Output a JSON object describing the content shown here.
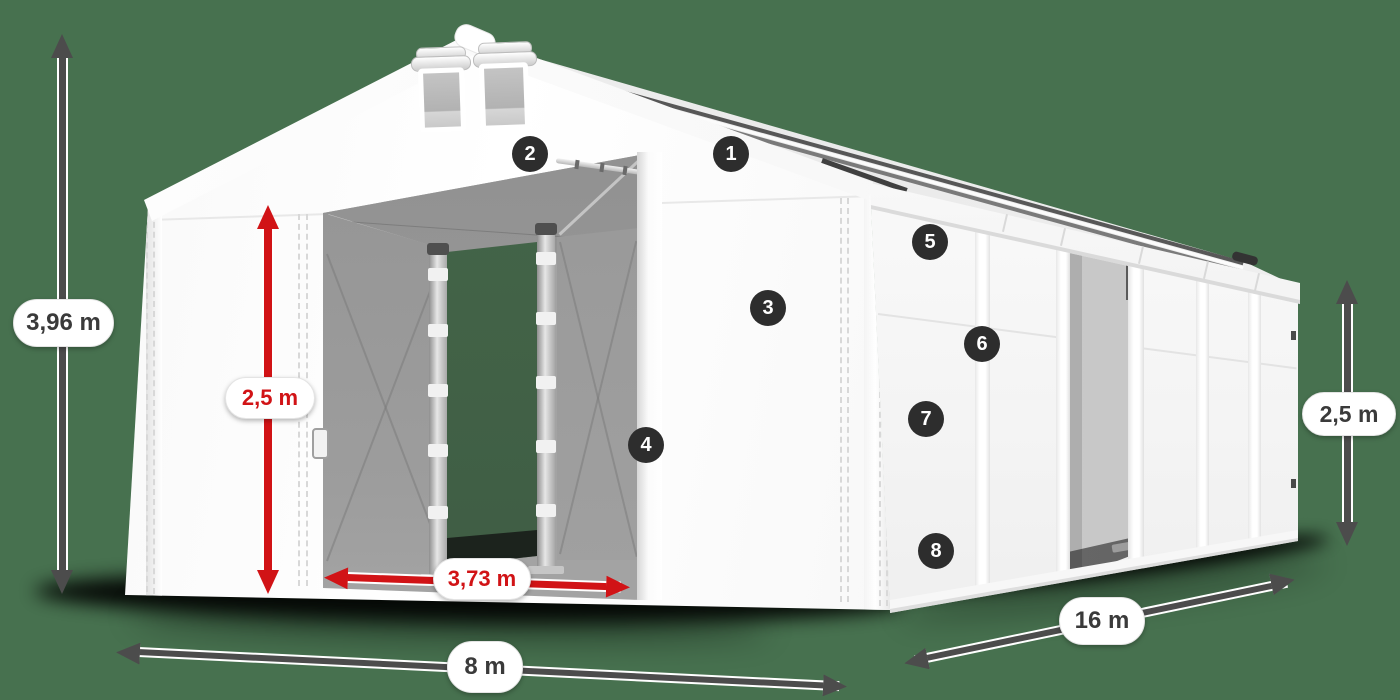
{
  "diagram": {
    "type": "product-dimension-diagram",
    "subject": "white storage tent with open front and side doors",
    "background_color": "#47714F"
  },
  "dimensions": {
    "total_height": {
      "label": "3,96 m",
      "style": "dark",
      "orientation": "vertical",
      "position": "far-left"
    },
    "door_height": {
      "label": "2,5 m",
      "style": "red",
      "orientation": "vertical",
      "position": "front-door"
    },
    "door_width": {
      "label": "3,73 m",
      "style": "red",
      "orientation": "horizontal",
      "position": "front-door-bottom"
    },
    "front_width": {
      "label": "8 m",
      "style": "dark",
      "orientation": "horizontal",
      "position": "bottom-front"
    },
    "side_length": {
      "label": "16 m",
      "style": "dark",
      "orientation": "diagonal",
      "position": "bottom-right"
    },
    "side_height": {
      "label": "2,5 m",
      "style": "dark",
      "orientation": "vertical",
      "position": "far-right"
    }
  },
  "markers": [
    {
      "number": "1"
    },
    {
      "number": "2"
    },
    {
      "number": "3"
    },
    {
      "number": "4"
    },
    {
      "number": "5"
    },
    {
      "number": "6"
    },
    {
      "number": "7"
    },
    {
      "number": "8"
    }
  ],
  "colors": {
    "background": "#47714F",
    "tent_fabric": "#FFFFFF",
    "interior_gray": "#A3A3A3",
    "dimension_dark": "#4C4C4C",
    "dimension_red": "#D11316",
    "pill_background": "#FFFFFF",
    "pill_text_dark": "#3A3A3A",
    "marker_background": "#2D2D2D",
    "marker_text": "#FFFFFF"
  }
}
